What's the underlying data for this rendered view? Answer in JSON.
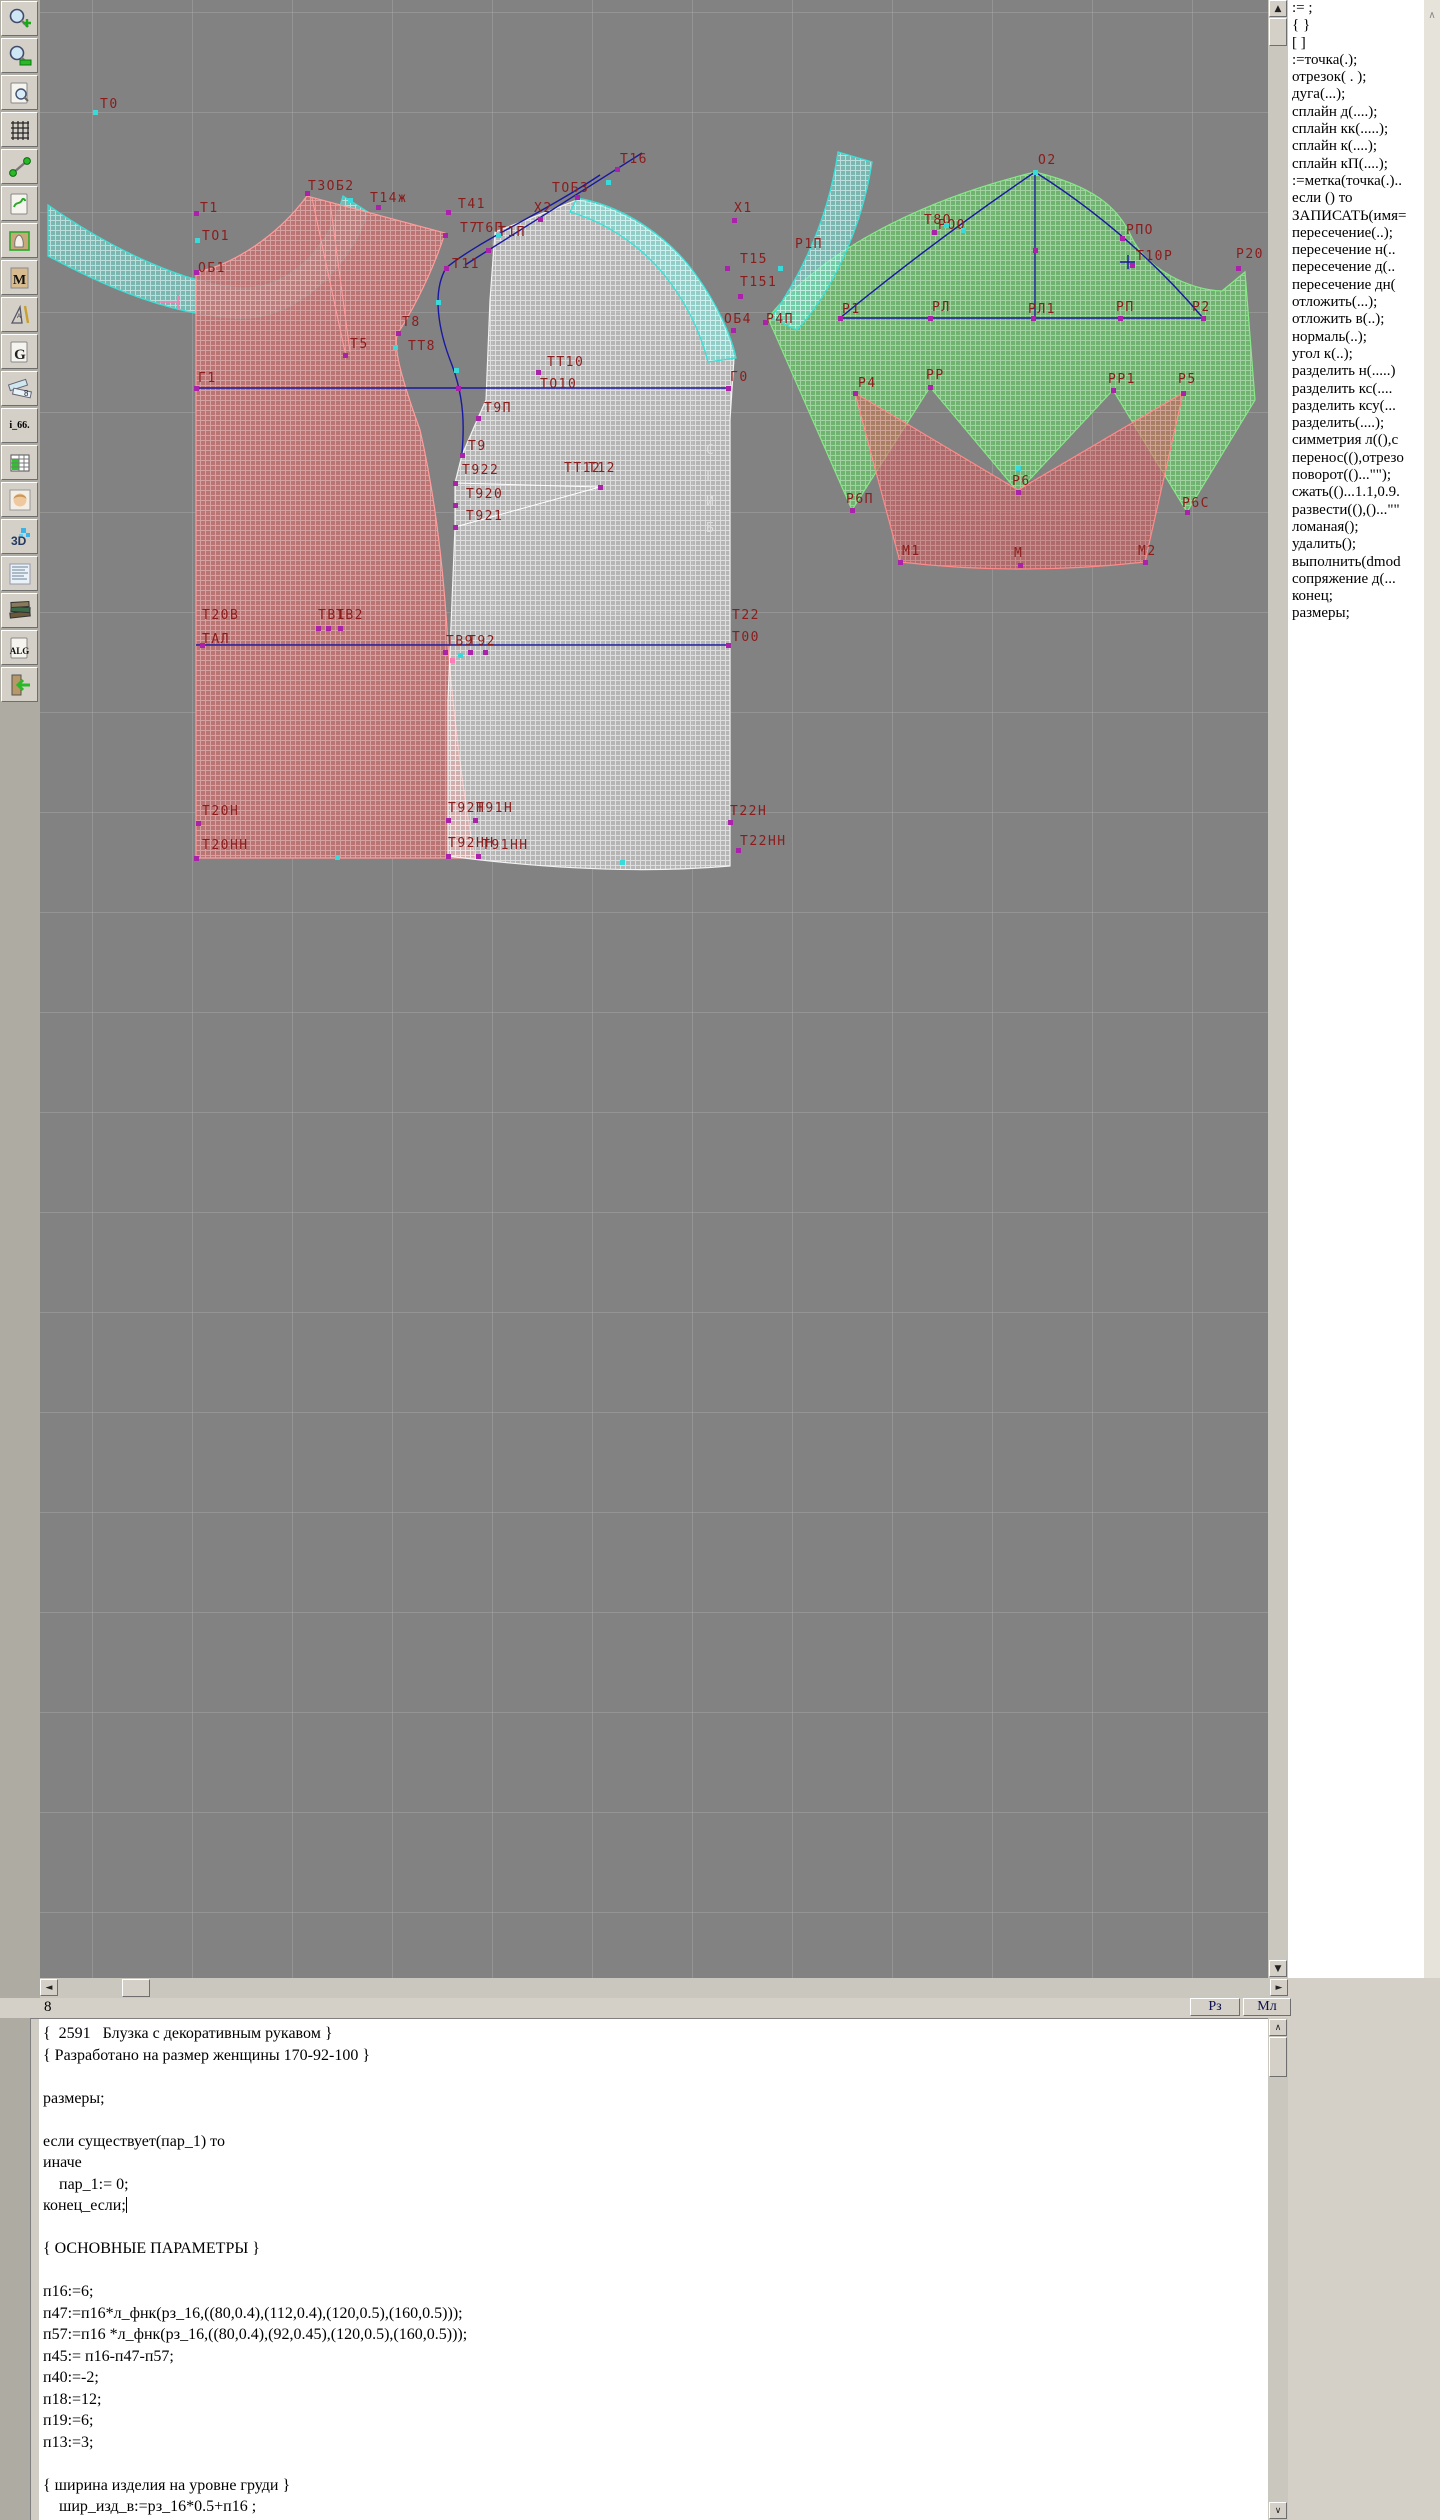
{
  "toolbar": {
    "items": [
      {
        "name": "zoom-in"
      },
      {
        "name": "zoom-out"
      },
      {
        "name": "preview"
      },
      {
        "name": "grid"
      },
      {
        "name": "segment"
      },
      {
        "name": "sheet-map"
      },
      {
        "name": "pattern-sheet"
      },
      {
        "name": "sheet-m",
        "label": "M"
      },
      {
        "name": "drafting-tools"
      },
      {
        "name": "sheet-g",
        "label": "G"
      },
      {
        "name": "measure-rulers",
        "label": "8"
      },
      {
        "name": "i66",
        "label": "i_66."
      },
      {
        "name": "table"
      },
      {
        "name": "portrait"
      },
      {
        "name": "threed",
        "label": "3D"
      },
      {
        "name": "text-sheet"
      },
      {
        "name": "books"
      },
      {
        "name": "alg",
        "label": "ALG"
      },
      {
        "name": "exit"
      }
    ]
  },
  "canvas": {
    "fold_label": "С\nГ\nИ\nБ",
    "labels": [
      {
        "t": "Т0",
        "x": 60,
        "y": 98
      },
      {
        "t": "Т1",
        "x": 160,
        "y": 202
      },
      {
        "t": "ТО1",
        "x": 162,
        "y": 230
      },
      {
        "t": "ОБ1",
        "x": 158,
        "y": 262
      },
      {
        "t": "Т3ОБ2",
        "x": 268,
        "y": 180
      },
      {
        "t": "Т14ж",
        "x": 330,
        "y": 192
      },
      {
        "t": "Т41",
        "x": 418,
        "y": 198
      },
      {
        "t": "Т7",
        "x": 420,
        "y": 222
      },
      {
        "t": "Т11",
        "x": 412,
        "y": 258
      },
      {
        "t": "Т5",
        "x": 310,
        "y": 338
      },
      {
        "t": "Т8",
        "x": 362,
        "y": 316
      },
      {
        "t": "ТТ8",
        "x": 368,
        "y": 340
      },
      {
        "t": "Г1",
        "x": 158,
        "y": 372
      },
      {
        "t": "Г0",
        "x": 690,
        "y": 371
      },
      {
        "t": "ТТ10",
        "x": 507,
        "y": 356
      },
      {
        "t": "ТО10",
        "x": 500,
        "y": 378
      },
      {
        "t": "Т9П",
        "x": 444,
        "y": 402
      },
      {
        "t": "Т9",
        "x": 428,
        "y": 440
      },
      {
        "t": "Т922",
        "x": 422,
        "y": 464
      },
      {
        "t": "Т920",
        "x": 426,
        "y": 488
      },
      {
        "t": "Т921",
        "x": 426,
        "y": 510
      },
      {
        "t": "ТТ12",
        "x": 524,
        "y": 462
      },
      {
        "t": "Т12",
        "x": 548,
        "y": 462
      },
      {
        "t": "Х2",
        "x": 494,
        "y": 202
      },
      {
        "t": "Т6П",
        "x": 436,
        "y": 222
      },
      {
        "t": "Т1П",
        "x": 458,
        "y": 226
      },
      {
        "t": "ТОБ3",
        "x": 512,
        "y": 182
      },
      {
        "t": "Т16",
        "x": 580,
        "y": 153
      },
      {
        "t": "Х1",
        "x": 694,
        "y": 202
      },
      {
        "t": "Т15",
        "x": 700,
        "y": 253
      },
      {
        "t": "Т151",
        "x": 700,
        "y": 276
      },
      {
        "t": "ОБ4",
        "x": 684,
        "y": 313
      },
      {
        "t": "Р4П",
        "x": 726,
        "y": 313
      },
      {
        "t": "Р1П",
        "x": 755,
        "y": 238
      },
      {
        "t": "Т8О",
        "x": 884,
        "y": 214
      },
      {
        "t": "РОО",
        "x": 898,
        "y": 219
      },
      {
        "t": "О2",
        "x": 998,
        "y": 154
      },
      {
        "t": "РПО",
        "x": 1086,
        "y": 224
      },
      {
        "t": "Т10Р",
        "x": 1096,
        "y": 250
      },
      {
        "t": "Р20",
        "x": 1196,
        "y": 248
      },
      {
        "t": "Р1",
        "x": 802,
        "y": 303
      },
      {
        "t": "РЛ",
        "x": 892,
        "y": 301
      },
      {
        "t": "РЛ1",
        "x": 988,
        "y": 303
      },
      {
        "t": "РП",
        "x": 1076,
        "y": 301
      },
      {
        "t": "Р2",
        "x": 1152,
        "y": 301
      },
      {
        "t": "Р4",
        "x": 818,
        "y": 377
      },
      {
        "t": "РР",
        "x": 886,
        "y": 369
      },
      {
        "t": "РР1",
        "x": 1068,
        "y": 373
      },
      {
        "t": "Р5",
        "x": 1138,
        "y": 373
      },
      {
        "t": "Р6П",
        "x": 806,
        "y": 493
      },
      {
        "t": "Р6",
        "x": 972,
        "y": 475
      },
      {
        "t": "Р6С",
        "x": 1142,
        "y": 497
      },
      {
        "t": "М1",
        "x": 862,
        "y": 545
      },
      {
        "t": "М",
        "x": 974,
        "y": 547
      },
      {
        "t": "М2",
        "x": 1098,
        "y": 545
      },
      {
        "t": "Т20В",
        "x": 162,
        "y": 609
      },
      {
        "t": "ТАЛ",
        "x": 162,
        "y": 633
      },
      {
        "t": "ТВ1",
        "x": 278,
        "y": 609
      },
      {
        "t": "ТВ2",
        "x": 296,
        "y": 609
      },
      {
        "t": "ТВ9",
        "x": 406,
        "y": 635
      },
      {
        "t": "Т92",
        "x": 428,
        "y": 635
      },
      {
        "t": "Т22",
        "x": 692,
        "y": 609
      },
      {
        "t": "Т00",
        "x": 692,
        "y": 631
      },
      {
        "t": "Т20Н",
        "x": 162,
        "y": 805
      },
      {
        "t": "Т20НН",
        "x": 162,
        "y": 839
      },
      {
        "t": "Т92Н",
        "x": 408,
        "y": 802
      },
      {
        "t": "Т91Н",
        "x": 436,
        "y": 802
      },
      {
        "t": "Т92НН",
        "x": 408,
        "y": 837
      },
      {
        "t": "Т91НН",
        "x": 442,
        "y": 839
      },
      {
        "t": "Т22Н",
        "x": 690,
        "y": 805
      },
      {
        "t": "Т22НН",
        "x": 700,
        "y": 835
      }
    ],
    "points": [
      {
        "x": 55,
        "y": 112,
        "c": "c"
      },
      {
        "x": 156,
        "y": 213,
        "c": "m"
      },
      {
        "x": 157,
        "y": 240,
        "c": "c"
      },
      {
        "x": 156,
        "y": 272,
        "c": "m"
      },
      {
        "x": 267,
        "y": 193,
        "c": "m"
      },
      {
        "x": 338,
        "y": 207,
        "c": "m"
      },
      {
        "x": 408,
        "y": 212,
        "c": "m"
      },
      {
        "x": 405,
        "y": 235,
        "c": "m"
      },
      {
        "x": 406,
        "y": 268,
        "c": "m"
      },
      {
        "x": 305,
        "y": 355,
        "c": "m"
      },
      {
        "x": 358,
        "y": 333,
        "c": "m"
      },
      {
        "x": 355,
        "y": 347,
        "c": "c"
      },
      {
        "x": 156,
        "y": 388,
        "c": "m"
      },
      {
        "x": 688,
        "y": 388,
        "c": "m"
      },
      {
        "x": 418,
        "y": 388,
        "c": "m"
      },
      {
        "x": 498,
        "y": 372,
        "c": "m"
      },
      {
        "x": 438,
        "y": 418,
        "c": "m"
      },
      {
        "x": 422,
        "y": 455,
        "c": "m"
      },
      {
        "x": 415,
        "y": 483,
        "c": "m"
      },
      {
        "x": 415,
        "y": 505,
        "c": "m"
      },
      {
        "x": 415,
        "y": 527,
        "c": "m"
      },
      {
        "x": 560,
        "y": 487,
        "c": "m"
      },
      {
        "x": 448,
        "y": 250,
        "c": "m"
      },
      {
        "x": 500,
        "y": 219,
        "c": "m"
      },
      {
        "x": 537,
        "y": 197,
        "c": "m"
      },
      {
        "x": 577,
        "y": 169,
        "c": "m"
      },
      {
        "x": 694,
        "y": 220,
        "c": "m"
      },
      {
        "x": 687,
        "y": 268,
        "c": "m"
      },
      {
        "x": 700,
        "y": 296,
        "c": "m"
      },
      {
        "x": 740,
        "y": 268,
        "c": "c"
      },
      {
        "x": 693,
        "y": 330,
        "c": "m"
      },
      {
        "x": 725,
        "y": 322,
        "c": "m"
      },
      {
        "x": 894,
        "y": 232,
        "c": "m"
      },
      {
        "x": 906,
        "y": 225,
        "c": "c"
      },
      {
        "x": 995,
        "y": 172,
        "c": "c"
      },
      {
        "x": 1082,
        "y": 238,
        "c": "m"
      },
      {
        "x": 1092,
        "y": 265,
        "c": "m"
      },
      {
        "x": 1198,
        "y": 268,
        "c": "m"
      },
      {
        "x": 800,
        "y": 318,
        "c": "m"
      },
      {
        "x": 890,
        "y": 318,
        "c": "m"
      },
      {
        "x": 993,
        "y": 318,
        "c": "m"
      },
      {
        "x": 1080,
        "y": 318,
        "c": "m"
      },
      {
        "x": 1163,
        "y": 318,
        "c": "m"
      },
      {
        "x": 995,
        "y": 250,
        "c": "m"
      },
      {
        "x": 923,
        "y": 230,
        "c": "c"
      },
      {
        "x": 815,
        "y": 393,
        "c": "m"
      },
      {
        "x": 890,
        "y": 387,
        "c": "m"
      },
      {
        "x": 1073,
        "y": 390,
        "c": "m"
      },
      {
        "x": 1143,
        "y": 393,
        "c": "m"
      },
      {
        "x": 812,
        "y": 510,
        "c": "m"
      },
      {
        "x": 978,
        "y": 492,
        "c": "m"
      },
      {
        "x": 978,
        "y": 468,
        "c": "c"
      },
      {
        "x": 1147,
        "y": 512,
        "c": "m"
      },
      {
        "x": 860,
        "y": 562,
        "c": "m"
      },
      {
        "x": 980,
        "y": 565,
        "c": "m"
      },
      {
        "x": 1105,
        "y": 562,
        "c": "m"
      },
      {
        "x": 162,
        "y": 645,
        "c": "m"
      },
      {
        "x": 688,
        "y": 645,
        "c": "m"
      },
      {
        "x": 412,
        "y": 660,
        "c": "p"
      },
      {
        "x": 278,
        "y": 628,
        "c": "m"
      },
      {
        "x": 288,
        "y": 628,
        "c": "m"
      },
      {
        "x": 300,
        "y": 628,
        "c": "m"
      },
      {
        "x": 405,
        "y": 652,
        "c": "m"
      },
      {
        "x": 430,
        "y": 652,
        "c": "m"
      },
      {
        "x": 445,
        "y": 652,
        "c": "m"
      },
      {
        "x": 158,
        "y": 823,
        "c": "m"
      },
      {
        "x": 156,
        "y": 858,
        "c": "m"
      },
      {
        "x": 408,
        "y": 820,
        "c": "m"
      },
      {
        "x": 435,
        "y": 820,
        "c": "m"
      },
      {
        "x": 408,
        "y": 856,
        "c": "m"
      },
      {
        "x": 438,
        "y": 856,
        "c": "m"
      },
      {
        "x": 690,
        "y": 822,
        "c": "m"
      },
      {
        "x": 698,
        "y": 850,
        "c": "m"
      },
      {
        "x": 458,
        "y": 235,
        "c": "c"
      },
      {
        "x": 398,
        "y": 302,
        "c": "c"
      },
      {
        "x": 416,
        "y": 370,
        "c": "c"
      },
      {
        "x": 568,
        "y": 182,
        "c": "c"
      },
      {
        "x": 297,
        "y": 857,
        "c": "c"
      },
      {
        "x": 582,
        "y": 862,
        "c": "c"
      },
      {
        "x": 310,
        "y": 200,
        "c": "c"
      },
      {
        "x": 420,
        "y": 655,
        "c": "c"
      }
    ]
  },
  "right_panel": {
    "commands": [
      ":= ;",
      "{  }",
      "[  ]",
      ":=точка(.);",
      "отрезок( . );",
      "дуга(...);",
      "сплайн  д(....);",
      "сплайн  кк(.....);",
      "сплайн  к(....);",
      "сплайн  кП(....);",
      ":=метка(точка(.)..",
      "если () то",
      "ЗАПИСАТЬ(имя=",
      "пересечение(..);",
      "пересечение  н(..",
      "пересечение  д(..",
      "пересечение  дн(",
      "отложить(...);",
      "отложить  в(..);",
      "нормаль(..);",
      "угол  к(..);",
      "разделить  н(.....)",
      "разделить  кс(....",
      "разделить  ксу(...",
      "разделить(....);",
      "симметрия  л((),с",
      "перенос((),отрезо",
      "поворот(()...\"\");",
      "сжать(()...1.1,0.9.",
      "развести((),()...\"\"",
      "ломаная();",
      "удалить();",
      "выполнить(dmod",
      "сопряжение  д(...",
      "конец;",
      "размеры;"
    ]
  },
  "statusbar": {
    "left": "8",
    "rz": "Рз",
    "ml": "Мл"
  },
  "editor": {
    "caret_line": 8,
    "lines": [
      "{  2591   Блузка с декоративным рукавом }",
      "{ Разработано на размер женщины 170-92-100 }",
      "",
      "размеры;",
      "",
      "если существует(пар_1) то",
      "иначе",
      "    пар_1:= 0;",
      "конец_если;",
      "",
      "{ ОСНОВНЫЕ ПАРАМЕТРЫ }",
      "",
      "п16:=6;",
      "п47:=п16*л_фнк(рз_16,((80,0.4),(112,0.4),(120,0.5),(160,0.5)));",
      "п57:=п16 *л_фнк(рз_16,((80,0.4),(92,0.45),(120,0.5),(160,0.5)));",
      "п45:= п16-п47-п57;",
      "п40:=-2;",
      "п18:=12;",
      "п19:=6;",
      "п13:=3;",
      "",
      "{ ширина изделия на уровне груди }",
      "    шир_изд_в:=рз_16*0.5+п16 ;"
    ]
  }
}
